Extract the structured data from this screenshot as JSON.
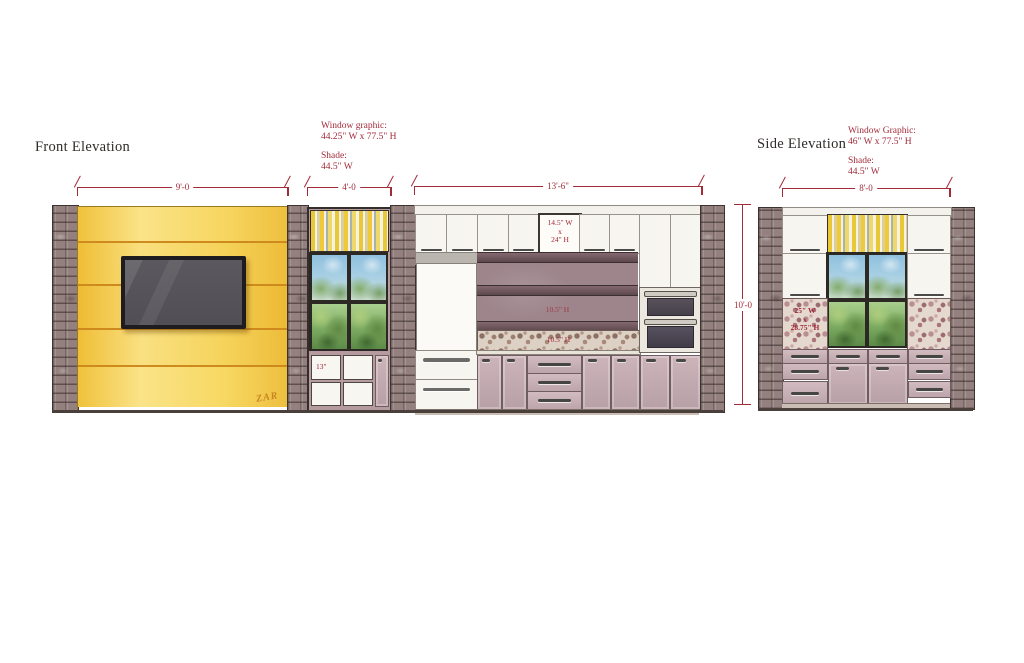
{
  "colors": {
    "dimension_red": "#a32a38",
    "title_ink": "#2f2b28",
    "wall_yellow": "#f2c94c",
    "cabinet_mauve": "#c2aab0",
    "brick_taupe": "#94817f"
  },
  "front": {
    "title": "Front Elevation",
    "annotation": {
      "graphic_label": "Window graphic:",
      "graphic_value": "44.25\" W x 77.5\" H",
      "shade_label": "Shade:",
      "shade_value": "44.5\" W"
    },
    "dimensions": {
      "media_wall_width": "9'-0",
      "window_bay_width": "4'-0",
      "kitchen_width": "13'-6\""
    },
    "labels": {
      "display_cabinet_w": "14.5\" W",
      "display_cabinet_x": "x",
      "display_cabinet_h": "24\" H",
      "open_shelf_height": "10.5\" H",
      "backsplash_height": "10.5\" H",
      "cubby_width": "13\""
    },
    "signature": "ZAR"
  },
  "side": {
    "title": "Side Elevation",
    "annotation": {
      "graphic_label": "Window Graphic:",
      "graphic_value": "46\" W x 77.5\" H",
      "shade_label": "Shade:",
      "shade_value": "44.5\" W"
    },
    "dimensions": {
      "wall_width": "8'-0",
      "wall_height": "10'-0"
    },
    "labels": {
      "mosaic_w": "25\" W",
      "mosaic_x": "x",
      "mosaic_h": "28.75\" H"
    }
  }
}
